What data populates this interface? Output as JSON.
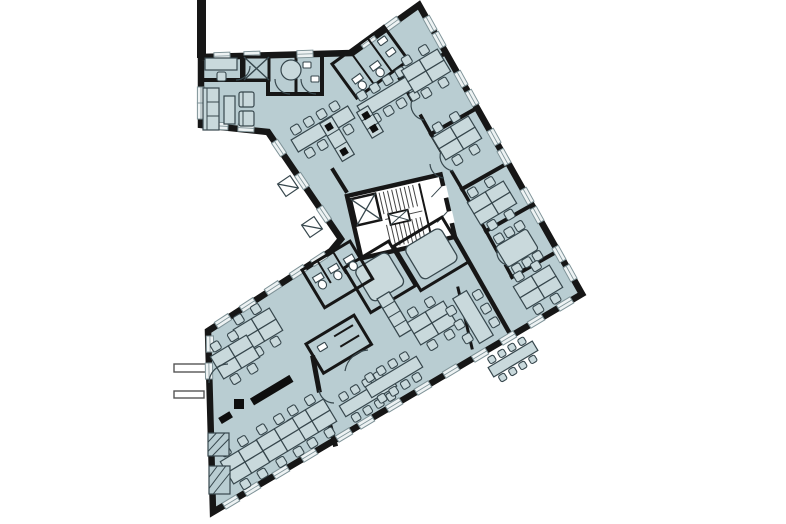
{
  "plan": {
    "canvas": {
      "w": 786,
      "h": 524
    },
    "colors": {
      "background": "#ffffff",
      "floor": "#b9cdd2",
      "wall": "#161616",
      "furniture_stroke": "#37474d",
      "furniture_fill": "#c9d9dc",
      "core_fill": "#ffffff",
      "window_fill": "#edf2f3",
      "window_stroke": "#7e9297",
      "dark_fill": "#0e0e0e"
    },
    "floor_polygon": [
      [
        201,
        57
      ],
      [
        352,
        53
      ],
      [
        419,
        5
      ],
      [
        582,
        294
      ],
      [
        213,
        512
      ],
      [
        208,
        331
      ],
      [
        331,
        251
      ],
      [
        341,
        239
      ],
      [
        268,
        132
      ],
      [
        201,
        125
      ]
    ],
    "party_wall": [
      197,
      0,
      9,
      58
    ],
    "stubs": [
      [
        174,
        364,
        33,
        8
      ],
      [
        174,
        391,
        30,
        7
      ]
    ],
    "outline_stroke": 6.5,
    "windows": [
      [
        430,
        24,
        61
      ],
      [
        439,
        40,
        61
      ],
      [
        461,
        79,
        61
      ],
      [
        472,
        98,
        61
      ],
      [
        494,
        137,
        61
      ],
      [
        504,
        157,
        61
      ],
      [
        527,
        196,
        61
      ],
      [
        537,
        215,
        61
      ],
      [
        559,
        254,
        61
      ],
      [
        570,
        273,
        61
      ],
      [
        565,
        304,
        -31
      ],
      [
        536,
        321,
        -31
      ],
      [
        508,
        338,
        -31
      ],
      [
        480,
        355,
        -31
      ],
      [
        451,
        371,
        -31
      ],
      [
        423,
        388,
        -31
      ],
      [
        394,
        405,
        -31
      ],
      [
        366,
        422,
        -31
      ],
      [
        344,
        435,
        -31
      ],
      [
        309,
        455,
        -31
      ],
      [
        281,
        472,
        -31
      ],
      [
        252,
        489,
        -31
      ],
      [
        231,
        502,
        -31
      ],
      [
        223,
        321,
        -33
      ],
      [
        248,
        305,
        -33
      ],
      [
        273,
        288,
        -33
      ],
      [
        298,
        272,
        -33
      ],
      [
        319,
        259,
        -33
      ],
      [
        324,
        214,
        56
      ],
      [
        302,
        181,
        56
      ],
      [
        279,
        148,
        56
      ],
      [
        222,
        56,
        -2
      ],
      [
        252,
        55,
        -2
      ],
      [
        305,
        54,
        -2
      ],
      [
        368,
        41,
        -36
      ],
      [
        392,
        24,
        -36
      ],
      [
        201,
        95,
        90
      ],
      [
        201,
        111,
        90
      ],
      [
        220,
        126,
        3
      ],
      [
        246,
        128,
        3
      ],
      [
        210,
        344,
        89
      ],
      [
        209,
        371,
        89
      ]
    ],
    "walls": [
      [
        201,
        80,
        268,
        80,
        4
      ],
      [
        242,
        57,
        242,
        80,
        4
      ],
      [
        268,
        57,
        268,
        94,
        4
      ],
      [
        268,
        94,
        322,
        94,
        4
      ],
      [
        296,
        57,
        296,
        94,
        3
      ],
      [
        322,
        57,
        322,
        94,
        4
      ],
      [
        333,
        170,
        346,
        191,
        4
      ],
      [
        446,
        53,
        400,
        79,
        4
      ],
      [
        477,
        108,
        431,
        134,
        4
      ],
      [
        508,
        163,
        462,
        189,
        4
      ],
      [
        532,
        205,
        486,
        231,
        4
      ],
      [
        558,
        251,
        512,
        277,
        4
      ],
      [
        400,
        79,
        412,
        100,
        3.5
      ],
      [
        421,
        116,
        431,
        134,
        3.5
      ],
      [
        431,
        134,
        441,
        151,
        3.5
      ],
      [
        452,
        172,
        462,
        189,
        3.5
      ],
      [
        462,
        189,
        486,
        231,
        3.5
      ],
      [
        486,
        231,
        497,
        251,
        3.5
      ],
      [
        506,
        266,
        512,
        277,
        3.5
      ],
      [
        455,
        237,
        509,
        332,
        4.5
      ],
      [
        458,
        288,
        472,
        348,
        3
      ],
      [
        313,
        358,
        319,
        390,
        5
      ],
      [
        325,
        408,
        335,
        444,
        5
      ]
    ],
    "rooms": [
      {
        "kind": "elevator",
        "x": 244,
        "y": 57,
        "rot": 0,
        "w": 25,
        "h": 23
      },
      {
        "kind": "outline",
        "name": "wc-block-top",
        "x": 332,
        "y": 64,
        "rot": -36,
        "w": 64,
        "h": 42,
        "lines": [
          [
            22,
            0,
            22,
            42
          ],
          [
            44,
            0,
            44,
            42
          ]
        ],
        "toilets": [
          [
            7,
            24
          ],
          [
            29,
            24
          ]
        ],
        "sinks": [
          [
            50,
            8
          ],
          [
            50,
            22
          ]
        ]
      },
      {
        "kind": "core",
        "x": 347,
        "y": 196,
        "rot": -13,
        "w": 96,
        "h": 64
      },
      {
        "kind": "meeting",
        "x": 344,
        "y": 268,
        "rot": -31,
        "w": 52,
        "h": 52,
        "pad": 7
      },
      {
        "kind": "meeting",
        "x": 394,
        "y": 246,
        "rot": -31,
        "w": 56,
        "h": 52,
        "pad": 7
      },
      {
        "kind": "outline",
        "name": "wc-block-lower",
        "x": 302,
        "y": 270,
        "rot": -31,
        "w": 56,
        "h": 44,
        "lines": [
          [
            18,
            0,
            18,
            26
          ],
          [
            36,
            0,
            36,
            26
          ]
        ],
        "toilets": [
          [
            5,
            12
          ],
          [
            23,
            12
          ],
          [
            41,
            12
          ]
        ],
        "sinks": []
      },
      {
        "kind": "outline",
        "name": "store-room",
        "x": 306,
        "y": 344,
        "rot": -31,
        "w": 56,
        "h": 34,
        "lines": [
          [
            28,
            8,
            50,
            8
          ],
          [
            28,
            20,
            50,
            20
          ]
        ],
        "toilets": [],
        "sinks": [
          [
            8,
            8
          ]
        ]
      },
      {
        "kind": "unit",
        "x": 377,
        "y": 299,
        "rot": -31,
        "w": 14,
        "h": 44,
        "lines": [
          [
            0,
            11,
            14,
            11
          ],
          [
            0,
            22,
            14,
            22
          ],
          [
            0,
            33,
            14,
            33
          ]
        ]
      }
    ],
    "furniture": [
      {
        "type": "desk",
        "x": 221,
        "y": 64,
        "rot": 0
      },
      {
        "type": "round-table",
        "x": 291,
        "y": 70,
        "r": 10
      },
      {
        "type": "sink",
        "x": 303,
        "y": 62
      },
      {
        "type": "sink",
        "x": 311,
        "y": 76
      },
      {
        "type": "lounge",
        "x": 203,
        "y": 88,
        "rot": 0
      },
      {
        "type": "longtable",
        "x": 323,
        "y": 129,
        "rot": -31
      },
      {
        "type": "longtable",
        "x": 389,
        "y": 95,
        "rot": -31
      },
      {
        "type": "counter",
        "x": 337,
        "y": 139,
        "rot": -31,
        "w": 14,
        "h": 44
      },
      {
        "type": "counter",
        "x": 370,
        "y": 122,
        "rot": -31,
        "w": 13,
        "h": 30
      },
      {
        "type": "desk-quad",
        "x": 426,
        "y": 71,
        "rot": -31
      },
      {
        "type": "desk-quad",
        "x": 457,
        "y": 138,
        "rot": -31
      },
      {
        "type": "desk-quad",
        "x": 492,
        "y": 203,
        "rot": -31
      },
      {
        "type": "meet6",
        "x": 517,
        "y": 248,
        "rot": -31
      },
      {
        "type": "desk-quad",
        "x": 538,
        "y": 287,
        "rot": -31
      },
      {
        "type": "desk-quad",
        "x": 432,
        "y": 323,
        "rot": -31
      },
      {
        "type": "tableV",
        "x": 473,
        "y": 317,
        "rot": -31
      },
      {
        "type": "longtable",
        "x": 513,
        "y": 359,
        "rot": -31,
        "s": 0.78
      },
      {
        "type": "desk-quad",
        "x": 258,
        "y": 330,
        "rot": -31
      },
      {
        "type": "desk-quad",
        "x": 235,
        "y": 357,
        "rot": -31
      },
      {
        "type": "longtable",
        "x": 368,
        "y": 396,
        "rot": -31,
        "s": 0.9
      },
      {
        "type": "longtable",
        "x": 394,
        "y": 377,
        "rot": -31,
        "s": 0.9
      },
      {
        "type": "desk-quad",
        "x": 312,
        "y": 421,
        "rot": -31
      },
      {
        "type": "desk-quad",
        "x": 281,
        "y": 440,
        "rot": -31
      },
      {
        "type": "desk-quad",
        "x": 245,
        "y": 462,
        "rot": -31
      },
      {
        "type": "open-door",
        "x": 288,
        "y": 186,
        "rot": 56
      },
      {
        "type": "open-door",
        "x": 312,
        "y": 227,
        "rot": 56
      },
      {
        "type": "hatch",
        "x": 208,
        "y": 433,
        "w": 21,
        "h": 23
      },
      {
        "type": "hatch",
        "x": 209,
        "y": 466,
        "w": 21,
        "h": 28
      }
    ],
    "marks": [
      {
        "x": 252,
        "y": 402,
        "rot": -31,
        "w": 46,
        "h": 8
      },
      {
        "x": 234,
        "y": 404,
        "rot": 0,
        "w": 10,
        "h": 10
      },
      {
        "x": 220,
        "y": 421,
        "rot": -31,
        "w": 13,
        "h": 7
      }
    ],
    "arcs": [
      "M228,364 A19 19 0 0 0 209,383",
      "M236,80 A14 14 0 0 0 250,66",
      "M290,94 A15 15 0 0 1 275,79",
      "M316,94 A15 15 0 0 1 301,79",
      "M412,100 A15 15 0 0 0 424,120",
      "M441,151 A15 15 0 0 0 453,171",
      "M497,251 A13 13 0 0 0 507,265",
      "M345,371 A25 25 0 0 1 368,350",
      "M319,390 A15 15 0 0 0 334,403",
      "M444,178 A15 15 0 0 1 430,164"
    ]
  }
}
